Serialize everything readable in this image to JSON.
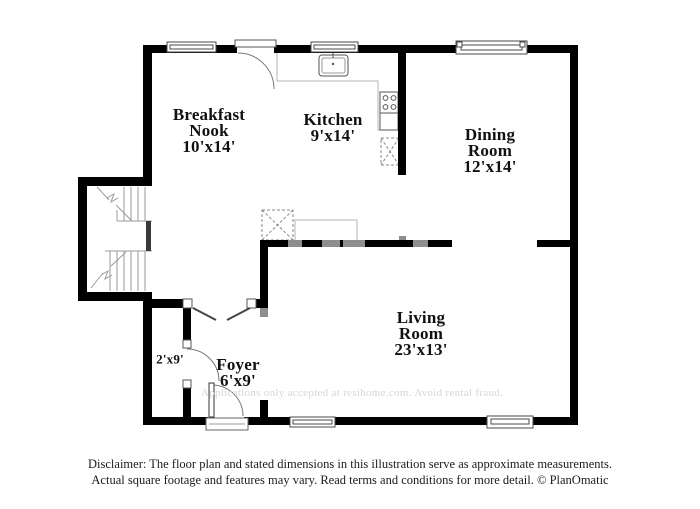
{
  "floorplan": {
    "rooms": [
      {
        "name": "Breakfast\nNook",
        "dims": "10'x14'"
      },
      {
        "name": "Kitchen",
        "dims": "9'x14'"
      },
      {
        "name": "Dining\nRoom",
        "dims": "12'x14'"
      },
      {
        "name": "Living\nRoom",
        "dims": "23'x13'"
      },
      {
        "name": "Foyer",
        "dims": "6'x9'"
      },
      {
        "name": "",
        "dims": "2'x9'"
      }
    ],
    "watermark": "Applications only accepted at resihome.com. Avoid rental fraud.",
    "disclaimer": {
      "line1": "Disclaimer: The floor plan and stated dimensions in this illustration serve as approximate measurements.",
      "line2": "Actual square footage and features may vary. Read terms and conditions for more detail. © PlanOmatic"
    },
    "colors": {
      "wall": "#000000",
      "opening": "#8e8e8e",
      "watermark": "#d6d6d6",
      "text": "#111111"
    }
  }
}
